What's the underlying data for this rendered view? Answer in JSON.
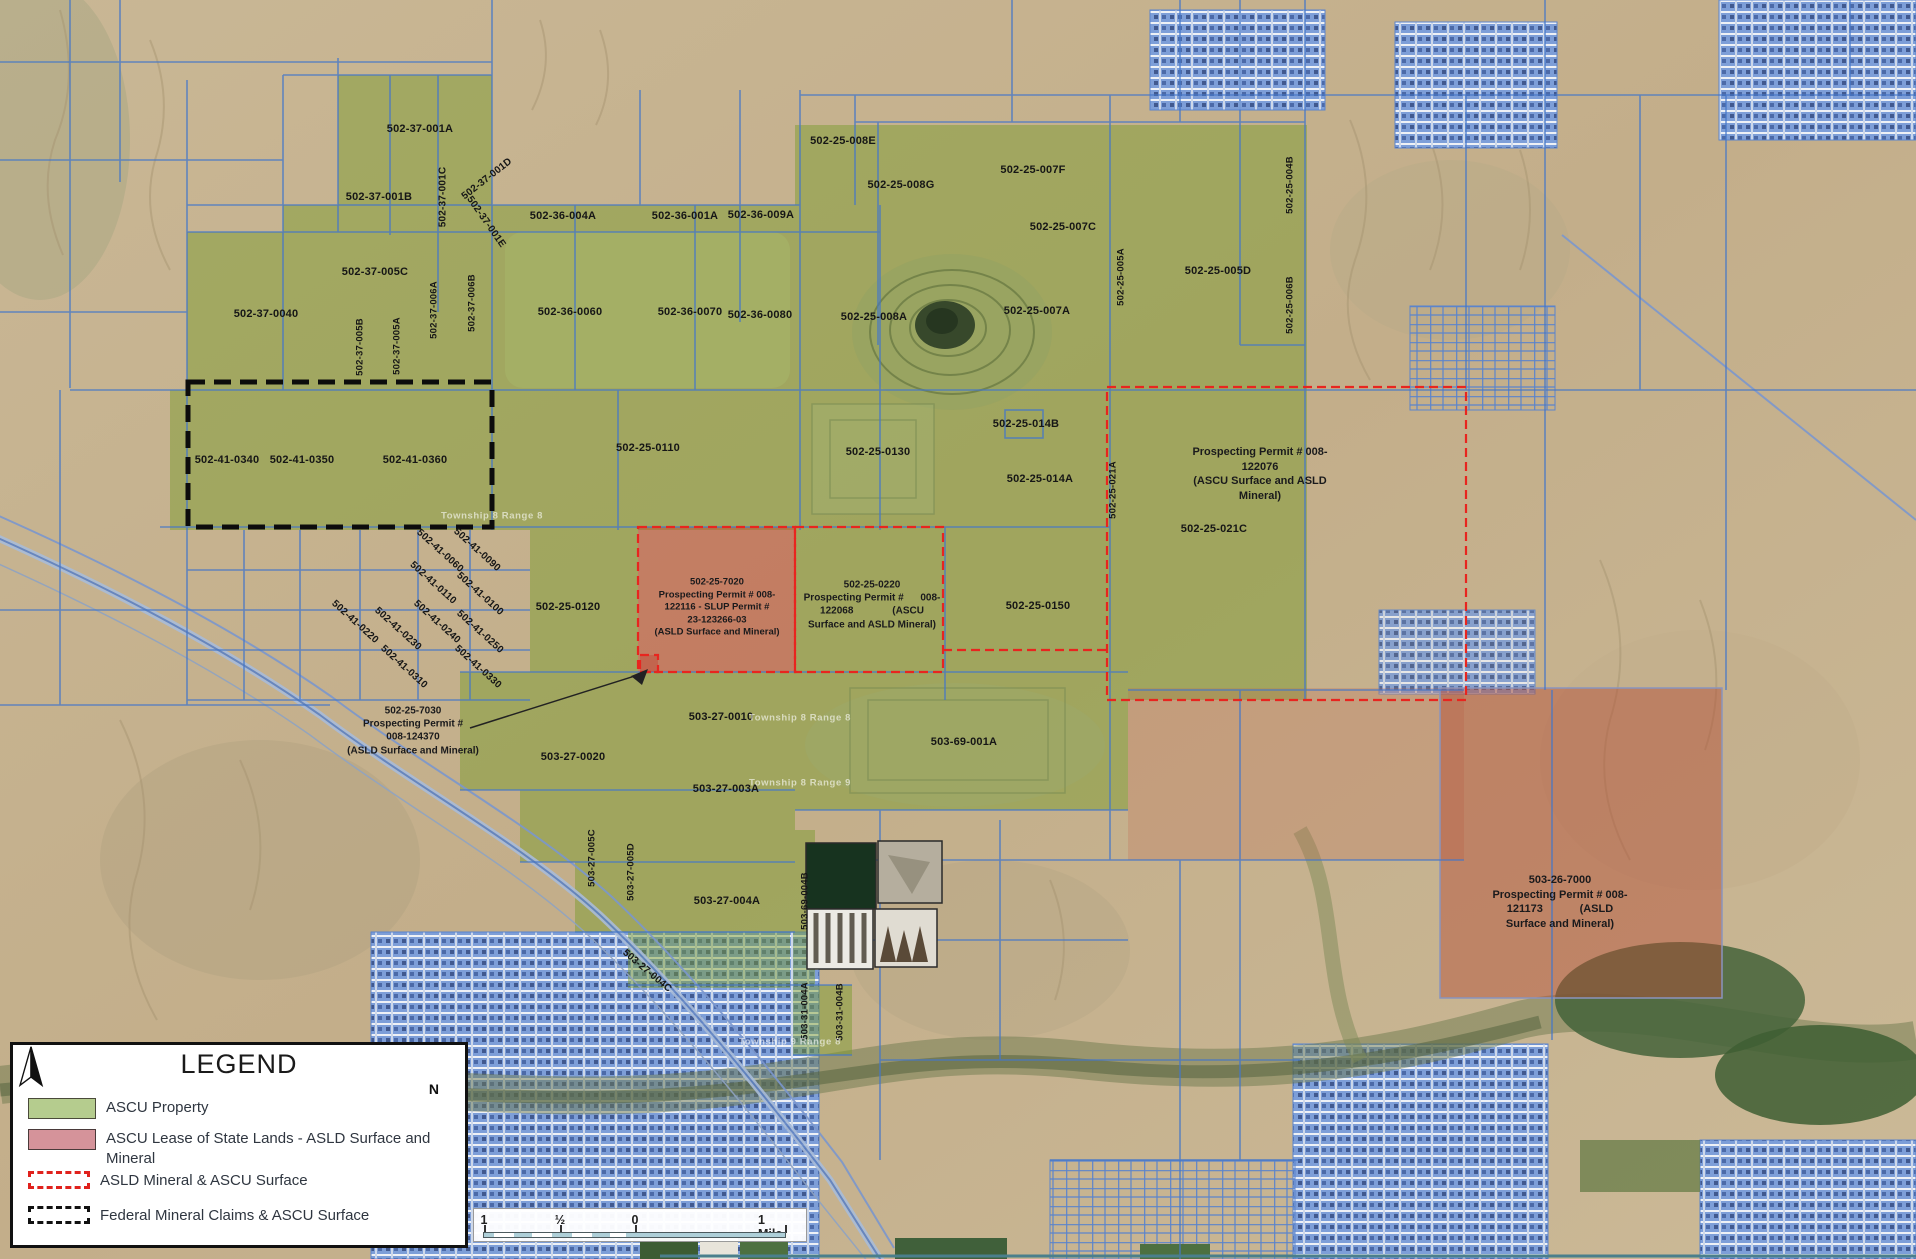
{
  "map": {
    "parcel_labels": [
      {
        "text": "502-37-001A",
        "x": 420,
        "y": 129
      },
      {
        "text": "502-37-001B",
        "x": 379,
        "y": 197
      },
      {
        "text": "502-37-001C",
        "x": 443,
        "y": 197,
        "rot": -90,
        "fs": 10
      },
      {
        "text": "502-37-001D",
        "x": 487,
        "y": 179,
        "rot": -38,
        "fs": 10
      },
      {
        "text": "502-37-001E",
        "x": 486,
        "y": 222,
        "rot": 55,
        "fs": 10
      },
      {
        "text": "502-36-004A",
        "x": 563,
        "y": 216
      },
      {
        "text": "502-36-001A",
        "x": 685,
        "y": 216
      },
      {
        "text": "502-36-009A",
        "x": 761,
        "y": 215
      },
      {
        "text": "502-37-005C",
        "x": 375,
        "y": 272
      },
      {
        "text": "502-36-0060",
        "x": 570,
        "y": 312
      },
      {
        "text": "502-36-0070",
        "x": 690,
        "y": 312
      },
      {
        "text": "502-36-0080",
        "x": 760,
        "y": 315
      },
      {
        "text": "502-25-008E",
        "x": 843,
        "y": 141
      },
      {
        "text": "502-25-008G",
        "x": 901,
        "y": 185
      },
      {
        "text": "502-25-007F",
        "x": 1033,
        "y": 170
      },
      {
        "text": "502-25-007C",
        "x": 1063,
        "y": 227
      },
      {
        "text": "502-25-005A",
        "x": 1121,
        "y": 277,
        "rot": -90,
        "fs": 9.5
      },
      {
        "text": "502-25-004B",
        "x": 1290,
        "y": 185,
        "rot": -90,
        "fs": 9.5
      },
      {
        "text": "502-25-005D",
        "x": 1218,
        "y": 271
      },
      {
        "text": "502-25-006B",
        "x": 1290,
        "y": 305,
        "rot": -90,
        "fs": 9.5
      },
      {
        "text": "502-25-007A",
        "x": 1037,
        "y": 311
      },
      {
        "text": "502-25-008A",
        "x": 874,
        "y": 317
      },
      {
        "text": "502-37-0040",
        "x": 266,
        "y": 314
      },
      {
        "text": "502-37-005B",
        "x": 360,
        "y": 347,
        "rot": -90,
        "fs": 9.5
      },
      {
        "text": "502-37-005A",
        "x": 397,
        "y": 346,
        "rot": -90,
        "fs": 9.5
      },
      {
        "text": "502-37-006A",
        "x": 434,
        "y": 310,
        "rot": -90,
        "fs": 9.5
      },
      {
        "text": "502-37-006B",
        "x": 472,
        "y": 303,
        "rot": -90,
        "fs": 9.5
      },
      {
        "text": "502-41-0340",
        "x": 227,
        "y": 460
      },
      {
        "text": "502-41-0350",
        "x": 302,
        "y": 460
      },
      {
        "text": "502-41-0360",
        "x": 415,
        "y": 460
      },
      {
        "text": "502-25-0110",
        "x": 648,
        "y": 448
      },
      {
        "text": "502-25-0130",
        "x": 878,
        "y": 452
      },
      {
        "text": "502-25-014B",
        "x": 1026,
        "y": 424
      },
      {
        "text": "502-25-014A",
        "x": 1040,
        "y": 479
      },
      {
        "text": "502-25-021A",
        "x": 1113,
        "y": 490,
        "rot": -90,
        "fs": 9.5
      },
      {
        "text": "502-25-021C",
        "x": 1214,
        "y": 529
      },
      {
        "text": "502-41-0060",
        "x": 440,
        "y": 551,
        "rot": 42,
        "fs": 10
      },
      {
        "text": "502-41-0090",
        "x": 477,
        "y": 550,
        "rot": 42,
        "fs": 10
      },
      {
        "text": "502-41-0110",
        "x": 433,
        "y": 583,
        "rot": 42,
        "fs": 10
      },
      {
        "text": "502-41-0100",
        "x": 480,
        "y": 594,
        "rot": 42,
        "fs": 10
      },
      {
        "text": "502-41-0220",
        "x": 355,
        "y": 622,
        "rot": 42,
        "fs": 10
      },
      {
        "text": "502-41-0230",
        "x": 398,
        "y": 629,
        "rot": 42,
        "fs": 10
      },
      {
        "text": "502-41-0240",
        "x": 437,
        "y": 622,
        "rot": 42,
        "fs": 10
      },
      {
        "text": "502-41-0250",
        "x": 480,
        "y": 632,
        "rot": 42,
        "fs": 10
      },
      {
        "text": "502-41-0310",
        "x": 404,
        "y": 667,
        "rot": 42,
        "fs": 10
      },
      {
        "text": "502-41-0330",
        "x": 478,
        "y": 667,
        "rot": 42,
        "fs": 10
      },
      {
        "text": "502-25-0120",
        "x": 568,
        "y": 607
      },
      {
        "text": "502-25-0150",
        "x": 1038,
        "y": 606
      },
      {
        "text": "503-27-0010",
        "x": 721,
        "y": 717
      },
      {
        "text": "503-27-0020",
        "x": 573,
        "y": 757
      },
      {
        "text": "503-27-003A",
        "x": 726,
        "y": 789
      },
      {
        "text": "503-69-001A",
        "x": 964,
        "y": 742
      },
      {
        "text": "503-27-004A",
        "x": 727,
        "y": 901
      },
      {
        "text": "503-27-005C",
        "x": 592,
        "y": 858,
        "rot": -90,
        "fs": 9.5
      },
      {
        "text": "503-27-005D",
        "x": 631,
        "y": 872,
        "rot": -90,
        "fs": 9.5
      },
      {
        "text": "503-27-004C",
        "x": 647,
        "y": 971,
        "rot": 40,
        "fs": 10
      },
      {
        "text": "503-69-004B",
        "x": 805,
        "y": 901,
        "rot": -90,
        "fs": 9.5
      },
      {
        "text": "503-31-004A",
        "x": 805,
        "y": 1011,
        "rot": -90,
        "fs": 9.5
      },
      {
        "text": "503-31-004B",
        "x": 840,
        "y": 1012,
        "rot": -90,
        "fs": 9.5
      }
    ],
    "annotations": [
      {
        "text": "Prospecting Permit # 008-\n122076\n(ASCU Surface and ASLD\nMineral)",
        "x": 1260,
        "y": 474,
        "w": 240,
        "fs": 11
      },
      {
        "text": "502-25-7020\nProspecting Permit # 008-\n122116 - SLUP Permit #\n23-123266-03\n(ASLD Surface and Mineral)",
        "x": 717,
        "y": 608,
        "w": 175,
        "fs": 9.5
      },
      {
        "text": "502-25-0220\nProspecting Permit #      008-\n122068              (ASCU\nSurface and ASLD Mineral)",
        "x": 872,
        "y": 605,
        "w": 190,
        "fs": 10
      },
      {
        "text": "502-25-7030\nProspecting Permit #\n008-124370\n(ASLD Surface and Mineral)",
        "x": 413,
        "y": 731,
        "w": 158,
        "fs": 10
      },
      {
        "text": "503-26-7000\nProspecting Permit # 008-\n121173            (ASLD\nSurface and Mineral)",
        "x": 1560,
        "y": 902,
        "w": 215,
        "fs": 11
      }
    ],
    "watermarks": [
      {
        "text": "Township 8 Range 8",
        "x": 800,
        "y": 718
      },
      {
        "text": "Township 8 Range 9",
        "x": 800,
        "y": 783
      },
      {
        "text": "Township 9 Range 8",
        "x": 790,
        "y": 1042
      },
      {
        "text": "Township 8 Range 8",
        "x": 492,
        "y": 516
      }
    ]
  },
  "legend": {
    "title": "LEGEND",
    "north_label": "N",
    "items": [
      {
        "swatch": "green",
        "label": "ASCU Property"
      },
      {
        "swatch": "pink",
        "label": "ASCU Lease of State Lands - ASLD Surface and Mineral"
      },
      {
        "swatch": "red-dashed",
        "label": "ASLD Mineral & ASCU Surface"
      },
      {
        "swatch": "black-dashed",
        "label": "Federal Mineral Claims & ASCU Surface"
      }
    ]
  },
  "scalebar": {
    "labels": [
      "1",
      "½",
      "0",
      "1 Mile"
    ]
  },
  "colors": {
    "ascu_green": "#b5cc8e",
    "lease_pink": "#d5939a",
    "asld_dashed_red": "#e8251f",
    "federal_dashed_black": "#111111",
    "parcel_line_blue": "#4577c8"
  }
}
